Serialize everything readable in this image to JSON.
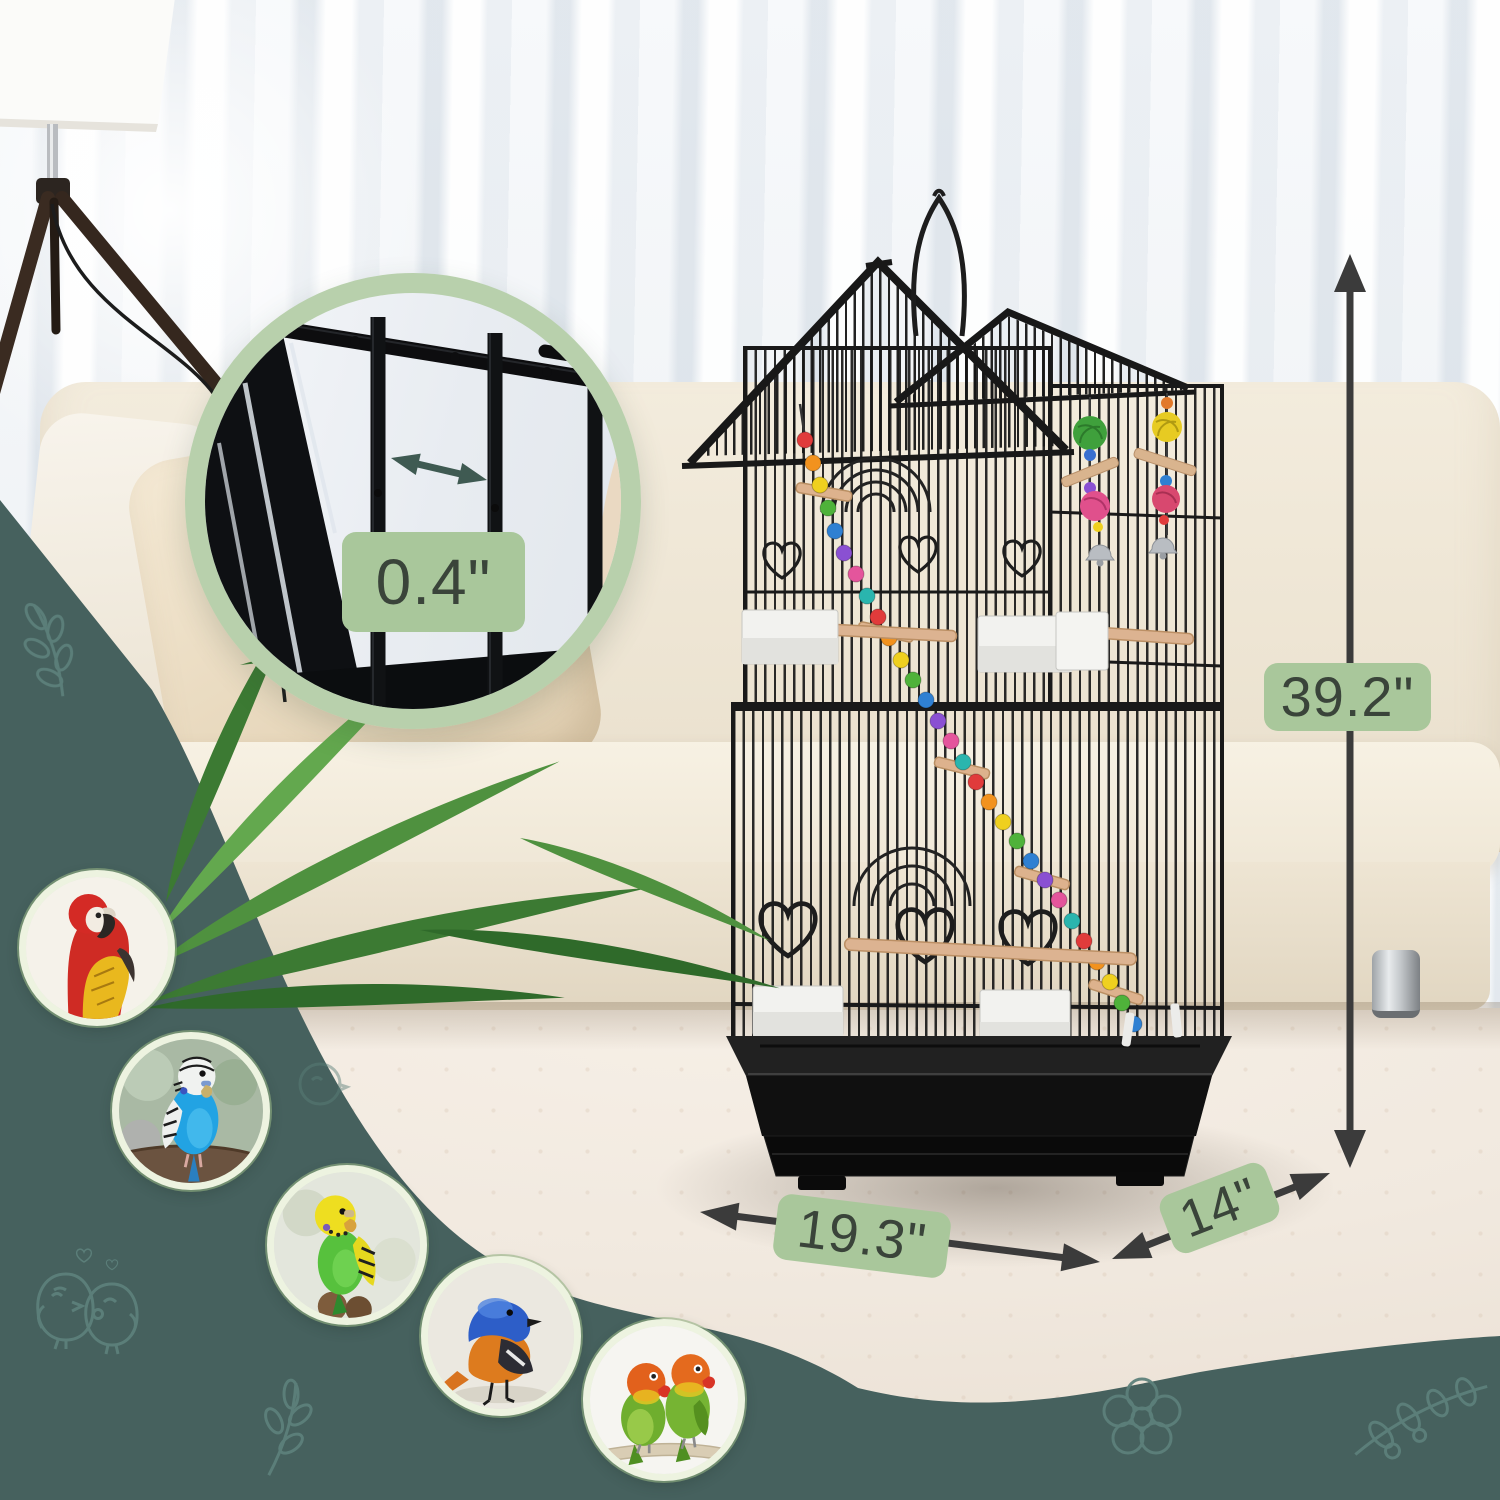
{
  "annotations": {
    "bar_spacing": {
      "label": "0.4\"",
      "measures": "wire bar spacing (shown in zoom circle)"
    },
    "height": {
      "label": "39.2\"",
      "measures": "cage height"
    },
    "width": {
      "label": "19.3\"",
      "measures": "cage base width"
    },
    "depth": {
      "label": "14\"",
      "measures": "cage base depth"
    }
  },
  "birds": [
    {
      "name": "scarlet-macaw"
    },
    {
      "name": "blue-budgerigar"
    },
    {
      "name": "green-budgerigar"
    },
    {
      "name": "blue-redstart"
    },
    {
      "name": "lovebirds-pair"
    }
  ],
  "doodles": [
    {
      "name": "leaf-sprig"
    },
    {
      "name": "cuddling-birds-with-hearts"
    },
    {
      "name": "chick"
    },
    {
      "name": "leaf-sprig"
    },
    {
      "name": "flower"
    },
    {
      "name": "leaf-branch"
    }
  ],
  "colors": {
    "teal_overlay": "#46615e",
    "doodle_stroke": "#5d807b",
    "label_bg": "#a9c79b",
    "label_text": "#3a443a",
    "dimension_arrow": "#3b3b3b",
    "zoom_ring": "#b8d0ac",
    "bird_ring": "#edf3e0",
    "cage_wire": "#1a1a1a",
    "couch": "#ece3d1",
    "rug": "#f1e9df"
  }
}
